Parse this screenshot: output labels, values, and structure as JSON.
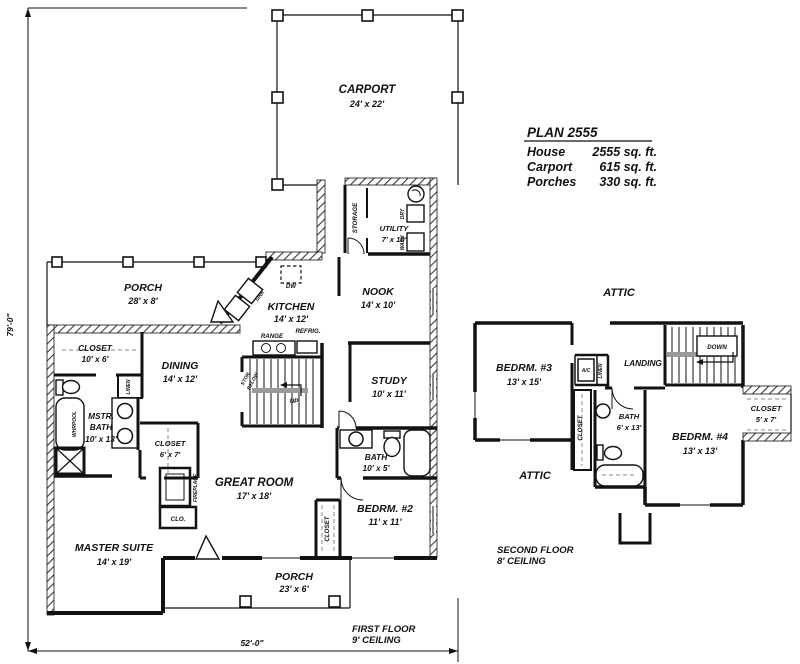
{
  "plan_info": {
    "title": "PLAN 2555",
    "rows": [
      {
        "label": "House",
        "value": "2555 sq. ft."
      },
      {
        "label": "Carport",
        "value": "615 sq. ft."
      },
      {
        "label": "Porches",
        "value": "330 sq. ft."
      }
    ]
  },
  "dimensions": {
    "overall_height": "79'-0\"",
    "overall_width": "52'-0\""
  },
  "captions": {
    "first_floor_line1": "FIRST FLOOR",
    "first_floor_line2": "9' CEILING",
    "second_floor_line1": "SECOND FLOOR",
    "second_floor_line2": "8' CEILING"
  },
  "first_floor": {
    "carport": {
      "name": "CARPORT",
      "size": "24' x 22'"
    },
    "storage": {
      "name": "STORAGE"
    },
    "utility": {
      "name": "UTILITY",
      "size": "7' x 10'"
    },
    "porch_front": {
      "name": "PORCH",
      "size": "28' x 8'"
    },
    "nook": {
      "name": "NOOK",
      "size": "14' x 10'"
    },
    "kitchen": {
      "name": "KITCHEN",
      "size": "14' x 12'"
    },
    "closet_hall": {
      "name": "CLOSET",
      "size": "10' x 6'"
    },
    "dining": {
      "name": "DINING",
      "size": "14' x 12'"
    },
    "master_bath": {
      "name_line1": "MSTR.",
      "name_line2": "BATH",
      "size": "10' x 13'"
    },
    "closet_master": {
      "name": "CLOSET",
      "size": "6' x 7'"
    },
    "study": {
      "name": "STUDY",
      "size": "10' x 11'"
    },
    "bath": {
      "name": "BATH",
      "size": "10' x 5'"
    },
    "great_room": {
      "name": "GREAT ROOM",
      "size": "17' x 18'"
    },
    "bedroom2": {
      "name": "BEDRM. #2",
      "size": "11' x 11'"
    },
    "master_suite": {
      "name": "MASTER SUITE",
      "size": "14' x 19'"
    },
    "porch_rear": {
      "name": "PORCH",
      "size": "23' x 6'"
    },
    "labels": {
      "linen": "LINEN",
      "whirlpool": "WHRPOOL",
      "fireplace": "FIREPLACE",
      "clo": "CLO.",
      "closet_bed2": "CLOSET",
      "dw": "DW",
      "sink": "SINK",
      "range": "RANGE",
      "refrig": "REFRIG.",
      "dry": "DRY",
      "wash": "WASH",
      "up": "UP",
      "stor": "STOR.",
      "below": "BELOW"
    }
  },
  "second_floor": {
    "attic_upper": "ATTIC",
    "attic_lower": "ATTIC",
    "bedroom3": {
      "name": "BEDRM. #3",
      "size": "13' x 15'"
    },
    "bedroom4": {
      "name": "BEDRM. #4",
      "size": "13' x 13'"
    },
    "landing": "LANDING",
    "down": "DOWN",
    "ac": "A/C",
    "linen": "LINEN",
    "closet_hall": "CLOSET",
    "bath": {
      "name": "BATH",
      "size": "6' x 13'"
    },
    "closet4": {
      "name": "CLOSET",
      "size": "5' x 7'"
    }
  }
}
